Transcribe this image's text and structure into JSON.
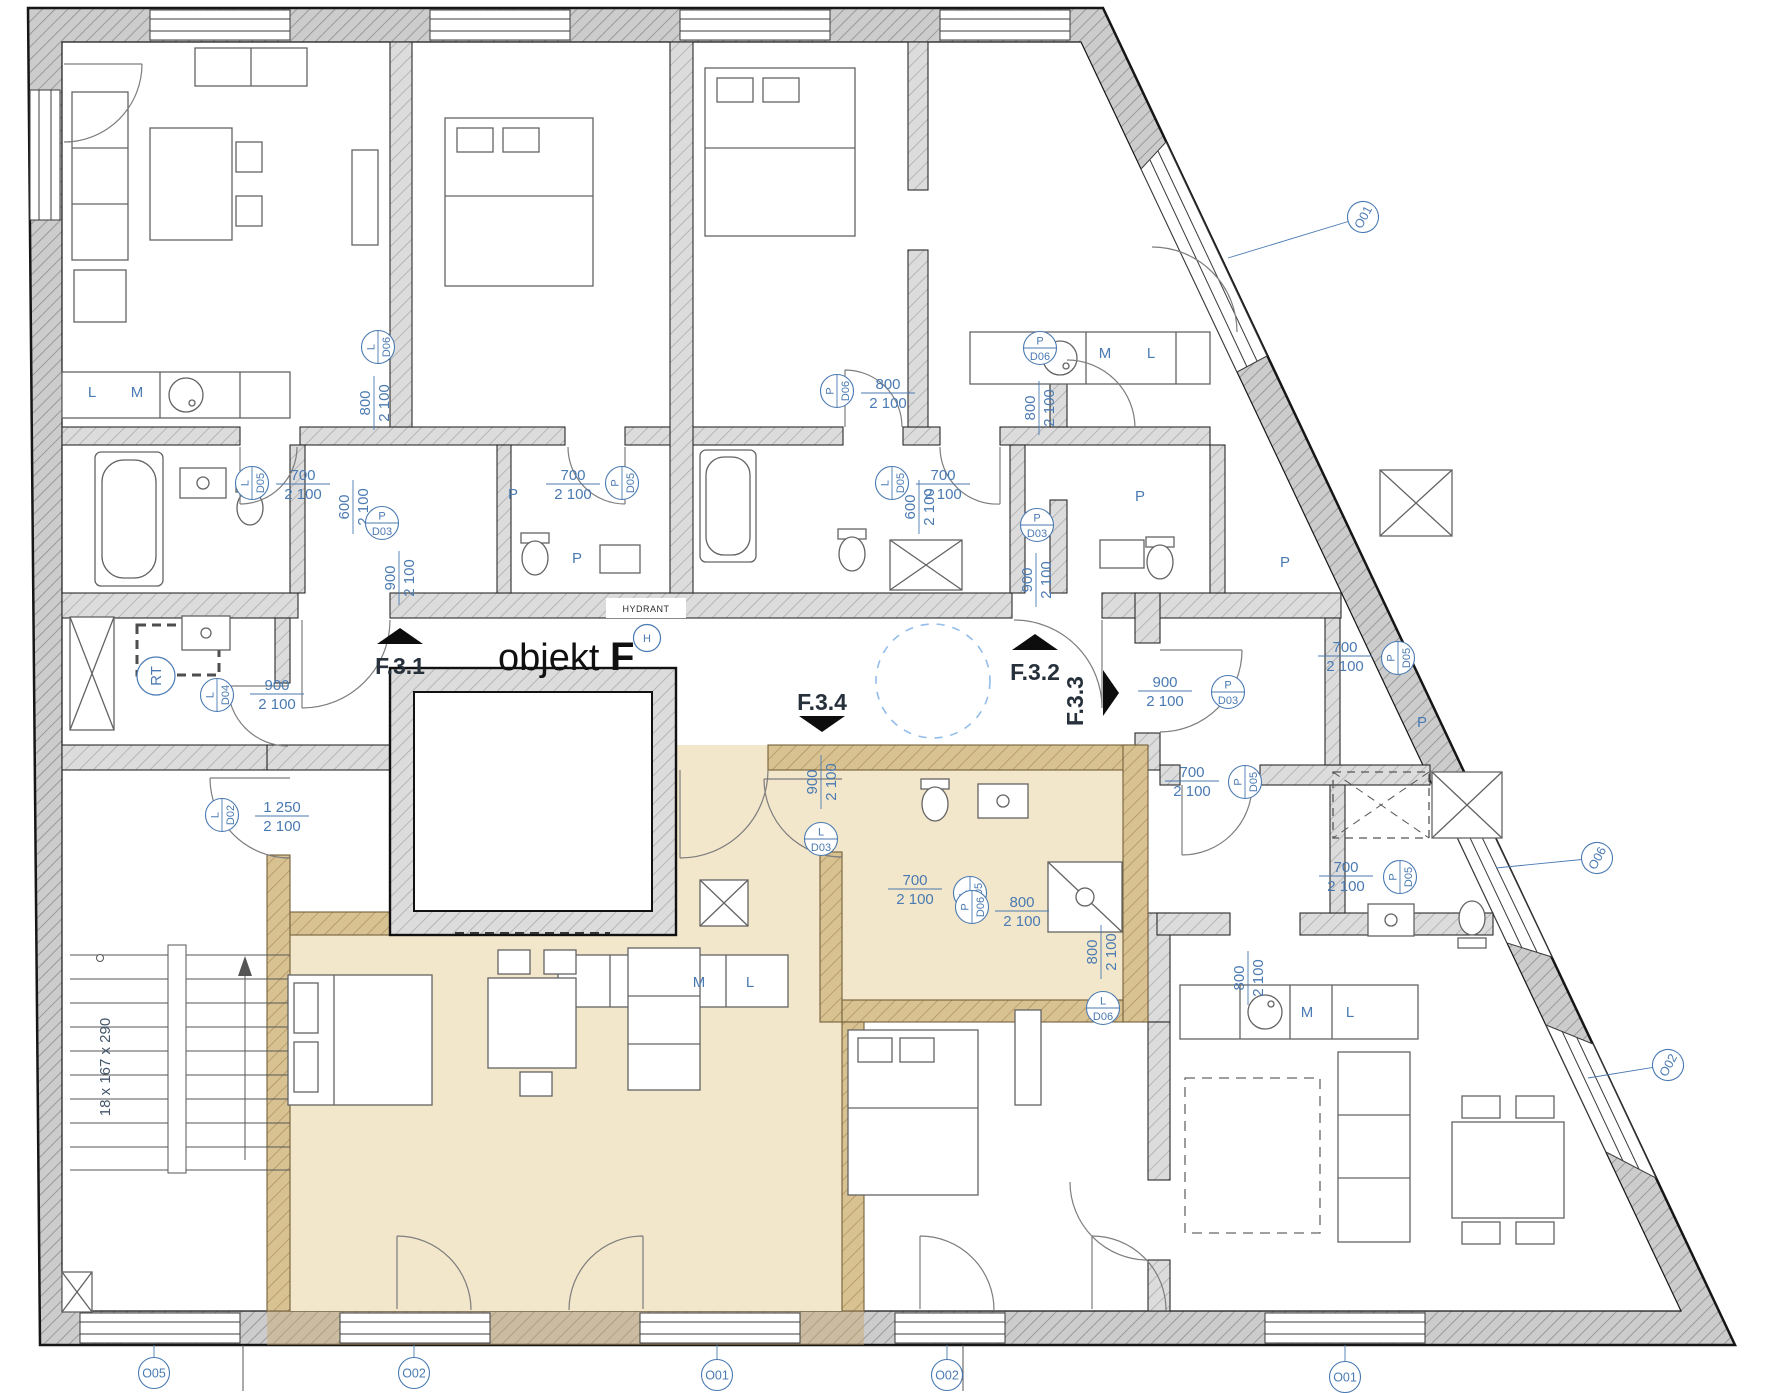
{
  "title": {
    "prefix": "objekt ",
    "suffix": "F"
  },
  "colors": {
    "accent_blue": "#4a7ab2",
    "highlight_unit": "#f3e7cb",
    "wall_gray": "#d2d2d2",
    "wall_beige": "#d8c08c",
    "ink": "#15181c"
  },
  "hydrant": {
    "text": "HYDRANT",
    "symbol": "H"
  },
  "stairs": {
    "label": "18 x 167 x 290"
  },
  "utility_tag": {
    "label": "RT",
    "x": 156,
    "y": 676,
    "rot": -90
  },
  "entries": [
    {
      "label": "F.3.1",
      "x": 400,
      "y": 644,
      "rot": 0,
      "tx": 0,
      "ty": 30,
      "trot": 0
    },
    {
      "label": "F.3.2",
      "x": 1035,
      "y": 650,
      "rot": 0,
      "tx": 0,
      "ty": 30,
      "trot": 0
    },
    {
      "label": "F.3.4",
      "x": 822,
      "y": 716,
      "rot": 180,
      "tx": 0,
      "ty": -6,
      "trot": 0
    },
    {
      "label": "F.3.3",
      "x": 1103,
      "y": 693,
      "rot": 90,
      "tx": -20,
      "ty": 8,
      "trot": -90
    }
  ],
  "door_tags": [
    {
      "leaf": "L",
      "code": "D06",
      "x": 378,
      "y": 347,
      "rot": -90
    },
    {
      "leaf": "L",
      "code": "D05",
      "x": 252,
      "y": 483,
      "rot": -90
    },
    {
      "leaf": "P",
      "code": "D05",
      "x": 622,
      "y": 483,
      "rot": -90
    },
    {
      "leaf": "P",
      "code": "D03",
      "x": 382,
      "y": 523,
      "rot": 0
    },
    {
      "leaf": "P",
      "code": "D06",
      "x": 837,
      "y": 391,
      "rot": -90
    },
    {
      "leaf": "L",
      "code": "D05",
      "x": 892,
      "y": 483,
      "rot": -90
    },
    {
      "leaf": "P",
      "code": "D06",
      "x": 1040,
      "y": 348,
      "rot": 0
    },
    {
      "leaf": "P",
      "code": "D03",
      "x": 1037,
      "y": 525,
      "rot": 0
    },
    {
      "leaf": "L",
      "code": "D04",
      "x": 217,
      "y": 695,
      "rot": -90
    },
    {
      "leaf": "L",
      "code": "D02",
      "x": 222,
      "y": 815,
      "rot": -90
    },
    {
      "leaf": "L",
      "code": "D03",
      "x": 821,
      "y": 839,
      "rot": 0
    },
    {
      "leaf": "P",
      "code": "D03",
      "x": 1228,
      "y": 692,
      "rot": 0
    },
    {
      "leaf": "L",
      "code": "D05",
      "x": 970,
      "y": 893,
      "rot": -90
    },
    {
      "leaf": "P",
      "code": "D05",
      "x": 1398,
      "y": 658,
      "rot": -90
    },
    {
      "leaf": "P",
      "code": "D05",
      "x": 1245,
      "y": 782,
      "rot": -90
    },
    {
      "leaf": "P",
      "code": "D05",
      "x": 1400,
      "y": 877,
      "rot": -90
    },
    {
      "leaf": "P",
      "code": "D06",
      "x": 972,
      "y": 907,
      "rot": -90
    },
    {
      "leaf": "L",
      "code": "D06",
      "x": 1103,
      "y": 1008,
      "rot": 0
    }
  ],
  "dims": [
    {
      "a": "700",
      "b": "2 100",
      "x": 303,
      "y": 483,
      "rot": 0
    },
    {
      "a": "700",
      "b": "2 100",
      "x": 573,
      "y": 483,
      "rot": 0
    },
    {
      "a": "800",
      "b": "2 100",
      "x": 888,
      "y": 392,
      "rot": 0
    },
    {
      "a": "700",
      "b": "2 100",
      "x": 943,
      "y": 483,
      "rot": 0
    },
    {
      "a": "800",
      "b": "2 100",
      "x": 1038,
      "y": 408,
      "rot": -90
    },
    {
      "a": "800",
      "b": "2 100",
      "x": 373,
      "y": 403,
      "rot": -90
    },
    {
      "a": "900",
      "b": "2 100",
      "x": 398,
      "y": 578,
      "rot": -90
    },
    {
      "a": "900",
      "b": "2 100",
      "x": 1035,
      "y": 580,
      "rot": -90
    },
    {
      "a": "900",
      "b": "2 100",
      "x": 820,
      "y": 782,
      "rot": -90
    },
    {
      "a": "900",
      "b": "2 100",
      "x": 1165,
      "y": 690,
      "rot": 0
    },
    {
      "a": "900",
      "b": "2 100",
      "x": 277,
      "y": 693,
      "rot": 0
    },
    {
      "a": "1 250",
      "b": "2 100",
      "x": 282,
      "y": 815,
      "rot": 0
    },
    {
      "a": "600",
      "b": "2 100",
      "x": 352,
      "y": 507,
      "rot": -90
    },
    {
      "a": "600",
      "b": "2 100",
      "x": 918,
      "y": 507,
      "rot": -90
    },
    {
      "a": "700",
      "b": "2 100",
      "x": 915,
      "y": 888,
      "rot": 0
    },
    {
      "a": "700",
      "b": "2 100",
      "x": 1345,
      "y": 655,
      "rot": 0
    },
    {
      "a": "700",
      "b": "2 100",
      "x": 1192,
      "y": 780,
      "rot": 0
    },
    {
      "a": "700",
      "b": "2 100",
      "x": 1346,
      "y": 875,
      "rot": 0
    },
    {
      "a": "800",
      "b": "2 100",
      "x": 1022,
      "y": 910,
      "rot": 0
    },
    {
      "a": "800",
      "b": "2 100",
      "x": 1100,
      "y": 952,
      "rot": -90
    },
    {
      "a": "800",
      "b": "2 100",
      "x": 1247,
      "y": 978,
      "rot": -90
    }
  ],
  "window_tags": [
    {
      "label": "O05",
      "x": 154,
      "y": 1373,
      "rot": 0,
      "lx": 154,
      "ly": 1345
    },
    {
      "label": "O02",
      "x": 414,
      "y": 1373,
      "rot": 0,
      "lx": 414,
      "ly": 1345
    },
    {
      "label": "O01",
      "x": 717,
      "y": 1375,
      "rot": 0,
      "lx": 717,
      "ly": 1345
    },
    {
      "label": "O02",
      "x": 947,
      "y": 1375,
      "rot": 0,
      "lx": 947,
      "ly": 1345
    },
    {
      "label": "O01",
      "x": 1345,
      "y": 1377,
      "rot": 0,
      "lx": 1345,
      "ly": 1345
    },
    {
      "label": "O01",
      "x": 1363,
      "y": 217,
      "rot": -62,
      "lx": 1228,
      "ly": 258
    },
    {
      "label": "O06",
      "x": 1597,
      "y": 858,
      "rot": -62,
      "lx": 1496,
      "ly": 868
    },
    {
      "label": "O02",
      "x": 1668,
      "y": 1065,
      "rot": -62,
      "lx": 1588,
      "ly": 1078
    }
  ],
  "room_letters": [
    {
      "t": "L",
      "x": 92,
      "y": 397
    },
    {
      "t": "M",
      "x": 137,
      "y": 397
    },
    {
      "t": "M",
      "x": 1105,
      "y": 358
    },
    {
      "t": "L",
      "x": 1151,
      "y": 358
    },
    {
      "t": "M",
      "x": 699,
      "y": 987
    },
    {
      "t": "L",
      "x": 750,
      "y": 987
    },
    {
      "t": "M",
      "x": 1307,
      "y": 1017
    },
    {
      "t": "L",
      "x": 1350,
      "y": 1017
    },
    {
      "t": "P",
      "x": 513,
      "y": 499
    },
    {
      "t": "P",
      "x": 577,
      "y": 563
    },
    {
      "t": "P",
      "x": 1140,
      "y": 501
    },
    {
      "t": "P",
      "x": 1285,
      "y": 567
    },
    {
      "t": "P",
      "x": 1422,
      "y": 727
    }
  ]
}
